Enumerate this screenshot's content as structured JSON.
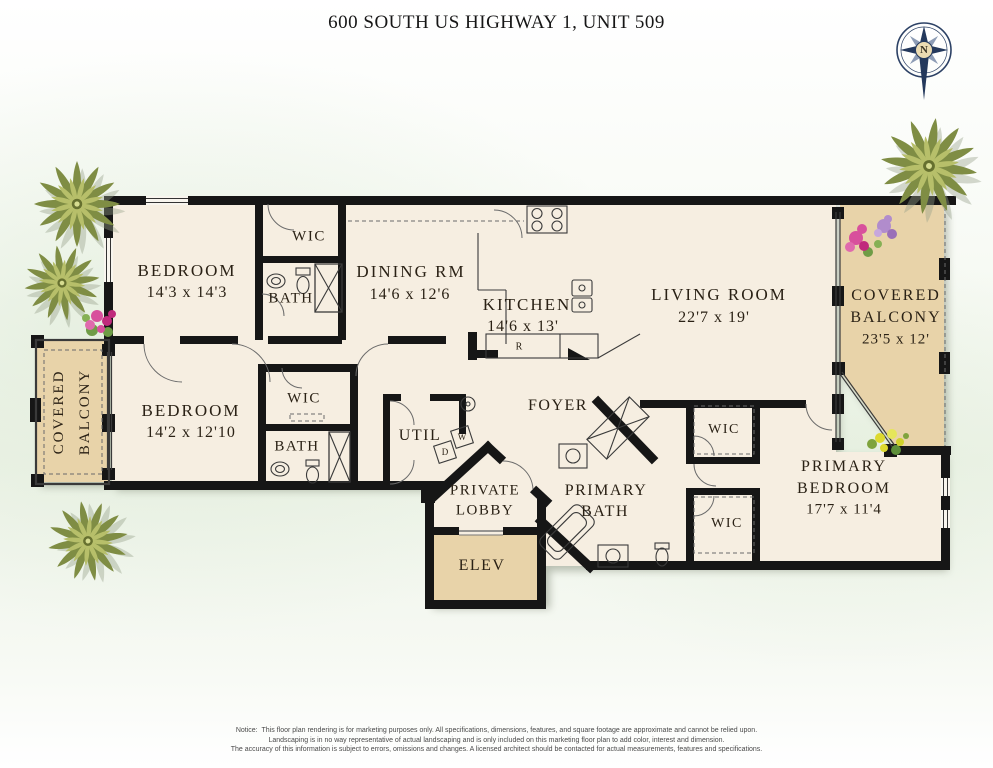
{
  "title": "600 SOUTH US HIGHWAY 1, UNIT 509",
  "compass": {
    "north_label": "N"
  },
  "rooms": {
    "bedroom1": {
      "name": "BEDROOM",
      "dims": "14'3 x 14'3"
    },
    "wic1": {
      "name": "WIC"
    },
    "bath1": {
      "name": "BATH"
    },
    "dining": {
      "name": "DINING  RM",
      "dims": "14'6 x 12'6"
    },
    "kitchen": {
      "name": "KITCHEN",
      "dims": "14'6 x 13'"
    },
    "living": {
      "name": "LIVING ROOM",
      "dims": "22'7 x 19'"
    },
    "balcony_right": {
      "line1": "COVERED",
      "line2": "BALCONY",
      "dims": "23'5 x 12'"
    },
    "balcony_left": {
      "line1": "COVERED",
      "line2": "BALCONY"
    },
    "bedroom2": {
      "name": "BEDROOM",
      "dims": "14'2 x 12'10"
    },
    "wic2": {
      "name": "WIC"
    },
    "bath2": {
      "name": "BATH"
    },
    "util": {
      "name": "UTIL"
    },
    "foyer": {
      "name": "FOYER"
    },
    "private_lobby": {
      "line1": "PRIVATE",
      "line2": "LOBBY"
    },
    "elevator": {
      "name": "ELEV"
    },
    "primary_bath": {
      "line1": "PRIMARY",
      "line2": "BATH"
    },
    "wic3": {
      "name": "WIC"
    },
    "wic4": {
      "name": "WIC"
    },
    "primary_bedroom": {
      "line1": "PRIMARY",
      "line2": "BEDROOM",
      "dims": "17'7 x 11'4"
    }
  },
  "appliances": {
    "refrigerator": "R",
    "washer": "W",
    "dryer": "D"
  },
  "notice": {
    "label": "Notice:",
    "lines": [
      "This floor plan rendering is for marketing purposes only. All specifications, dimensions, features, and square footage are approximate and cannot be relied upon.",
      "Landscaping is in no way representative of actual landscaping and is only included on this marketing floor plan to add color, interest and dimension.",
      "The accuracy of this information is subject to errors, omissions and changes. A licensed architect should be contacted for actual measurements, features and specifications."
    ]
  },
  "colors": {
    "floor": "#f6eee1",
    "balcony": "#e8d3a9",
    "wall": "#161616",
    "background_tint": "#e9f2e4",
    "compass": "#24395c",
    "palm": "#7f8d44"
  }
}
